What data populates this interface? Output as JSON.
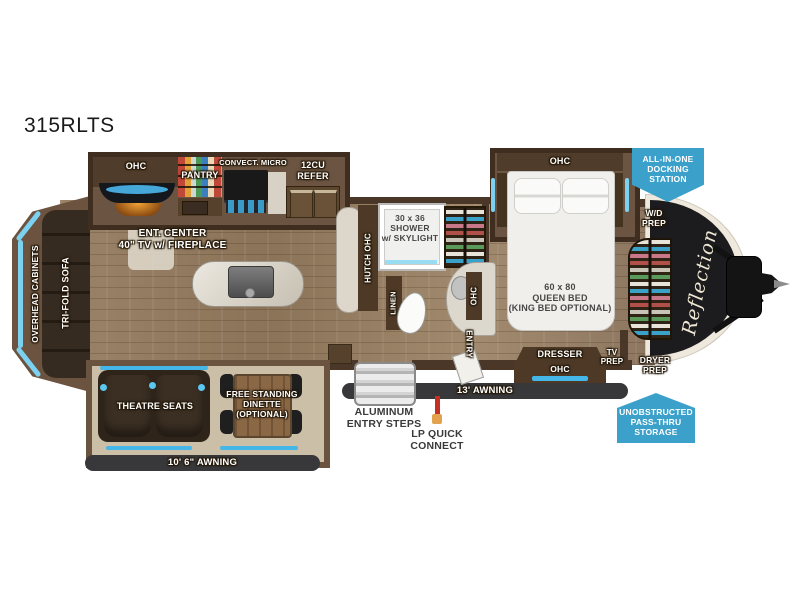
{
  "title": "315RLTS",
  "colors": {
    "accent_blue": "#45b6e8",
    "badge_blue": "#3ba1ca",
    "wall_brown": "#4a3727",
    "floor_tan": "#947c61",
    "awning_dark": "#38383a",
    "nose_black": "#1c1c1e"
  },
  "rear": {
    "overhead_cabinets": "OVERHEAD CABINETS",
    "trifold_sofa": "TRI-FOLD SOFA"
  },
  "kitchen": {
    "ohc": "OHC",
    "pantry": "PANTRY",
    "convect_micro": "CONVECT. MICRO",
    "refer": "12CU\nREFER",
    "ent_center": "ENT. CENTER\n40\" TV w/ FIREPLACE",
    "hutch": "HUTCH  OHC"
  },
  "bath": {
    "shower": "30 x 36\nSHOWER\nw/ SKYLIGHT",
    "linen": "LINEN",
    "ohc": "OHC",
    "entry": "ENTRY"
  },
  "bedroom": {
    "ohc_top": "OHC",
    "bed": "60 x 80\nQUEEN BED\n(KING BED OPTIONAL)",
    "dresser": "DRESSER",
    "dresser_ohc": "OHC",
    "tv_prep": "TV\nPREP",
    "wd_prep": "W/D\nPREP",
    "dryer_prep": "DRYER\nPREP"
  },
  "front": {
    "brand": "Reflection"
  },
  "living": {
    "theatre": "THEATRE SEATS",
    "dinette": "FREE STANDING\nDINETTE\n(OPTIONAL)"
  },
  "exterior": {
    "awning_main": "13' AWNING",
    "awning_patio": "10' 6\" AWNING",
    "steps": "ALUMINUM\nENTRY STEPS",
    "lp": "LP QUICK\nCONNECT"
  },
  "badges": {
    "docking": "ALL-IN-ONE\nDOCKING\nSTATION",
    "passthru": "UNOBSTRUCTED\nPASS-THRU\nSTORAGE"
  }
}
